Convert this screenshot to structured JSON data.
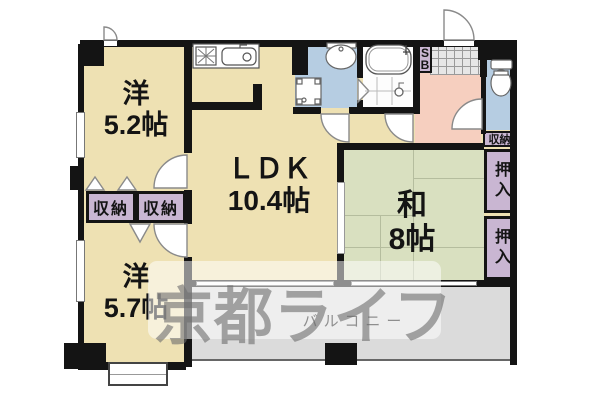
{
  "plan": {
    "rooms": {
      "west1": {
        "name": "洋",
        "size": "5.2帖"
      },
      "ldk": {
        "name": "ＬＤＫ",
        "size": "10.4帖"
      },
      "washitsu": {
        "name": "和",
        "size": "8帖"
      },
      "west2": {
        "name": "洋",
        "size": "5.7帖"
      }
    },
    "closets": {
      "storage_left_1": "収納",
      "storage_left_2": "収納",
      "storage_right": "収納",
      "oshiire_1": "押入",
      "oshiire_2": "押入",
      "shoebox_line1": "S",
      "shoebox_line2": "B"
    },
    "balcony_label": "バルコニー",
    "watermark": "京都ライフ",
    "fixtures": [
      "stove-icon",
      "kitchen-sink-icon",
      "washbasin-icon",
      "washing-machine-pan-icon",
      "bathtub-icon",
      "shower-tile-icon",
      "toilet-icon",
      "entrance-tile-icon"
    ],
    "colors": {
      "room_cream": "#eee1b3",
      "tatami_green": "#d9e0c0",
      "wet_area_blue": "#b6cde2",
      "hall_pink": "#f6cfbf",
      "closet_purple": "#c9b6d2",
      "balcony_gray": "#dbdbdb",
      "wall_black": "#141414"
    }
  }
}
